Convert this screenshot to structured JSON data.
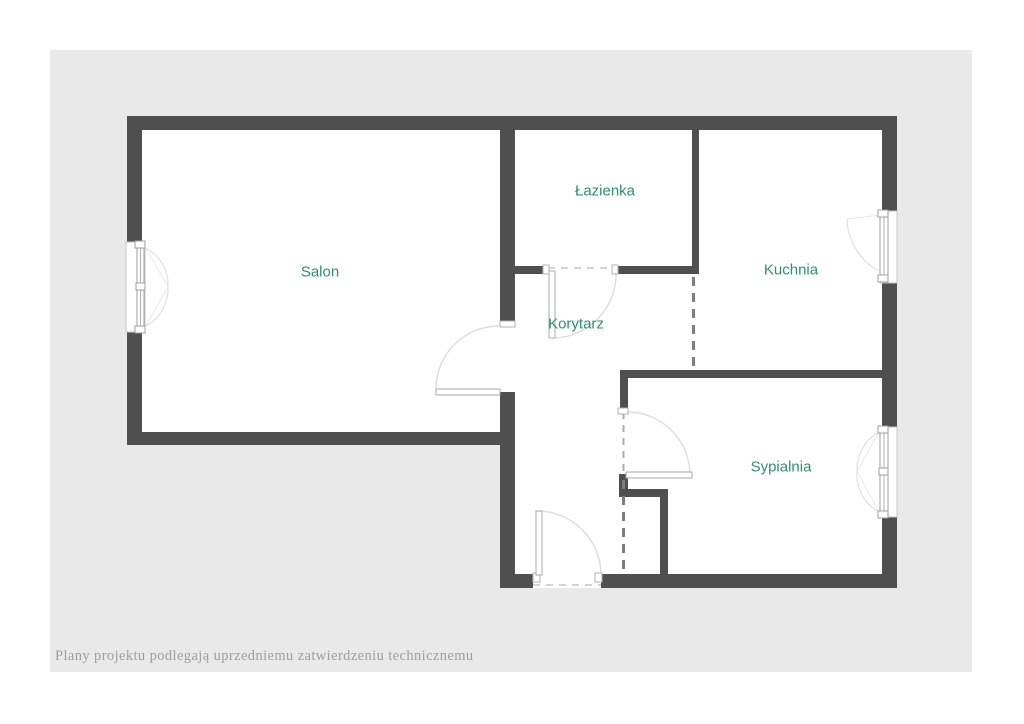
{
  "page": {
    "background_color": "#ffffff",
    "panel_background_color": "#e9e9e9"
  },
  "plan": {
    "type": "floor-plan",
    "wall_color": "#4f4f4f",
    "label_color": "#2e8e72",
    "rooms": [
      {
        "id": "salon",
        "label": "Salon"
      },
      {
        "id": "lazienka",
        "label": "Łazienka"
      },
      {
        "id": "kuchnia",
        "label": "Kuchnia"
      },
      {
        "id": "korytarz",
        "label": "Korytarz"
      },
      {
        "id": "sypialnia",
        "label": "Sypialnia"
      }
    ],
    "features": [
      "salon-window-left-wall",
      "kitchen-window-right-wall",
      "bedroom-window-right-wall",
      "salon-door",
      "bathroom-door",
      "bedroom-door",
      "entrance-door",
      "dashed-area-divider-kitchen-corridor",
      "dashed-area-divider-corridor-nook"
    ]
  },
  "footer": {
    "disclaimer": "Plany projektu podlegają uprzedniemu zatwierdzeniu technicznemu",
    "color": "#9e9e9e"
  }
}
